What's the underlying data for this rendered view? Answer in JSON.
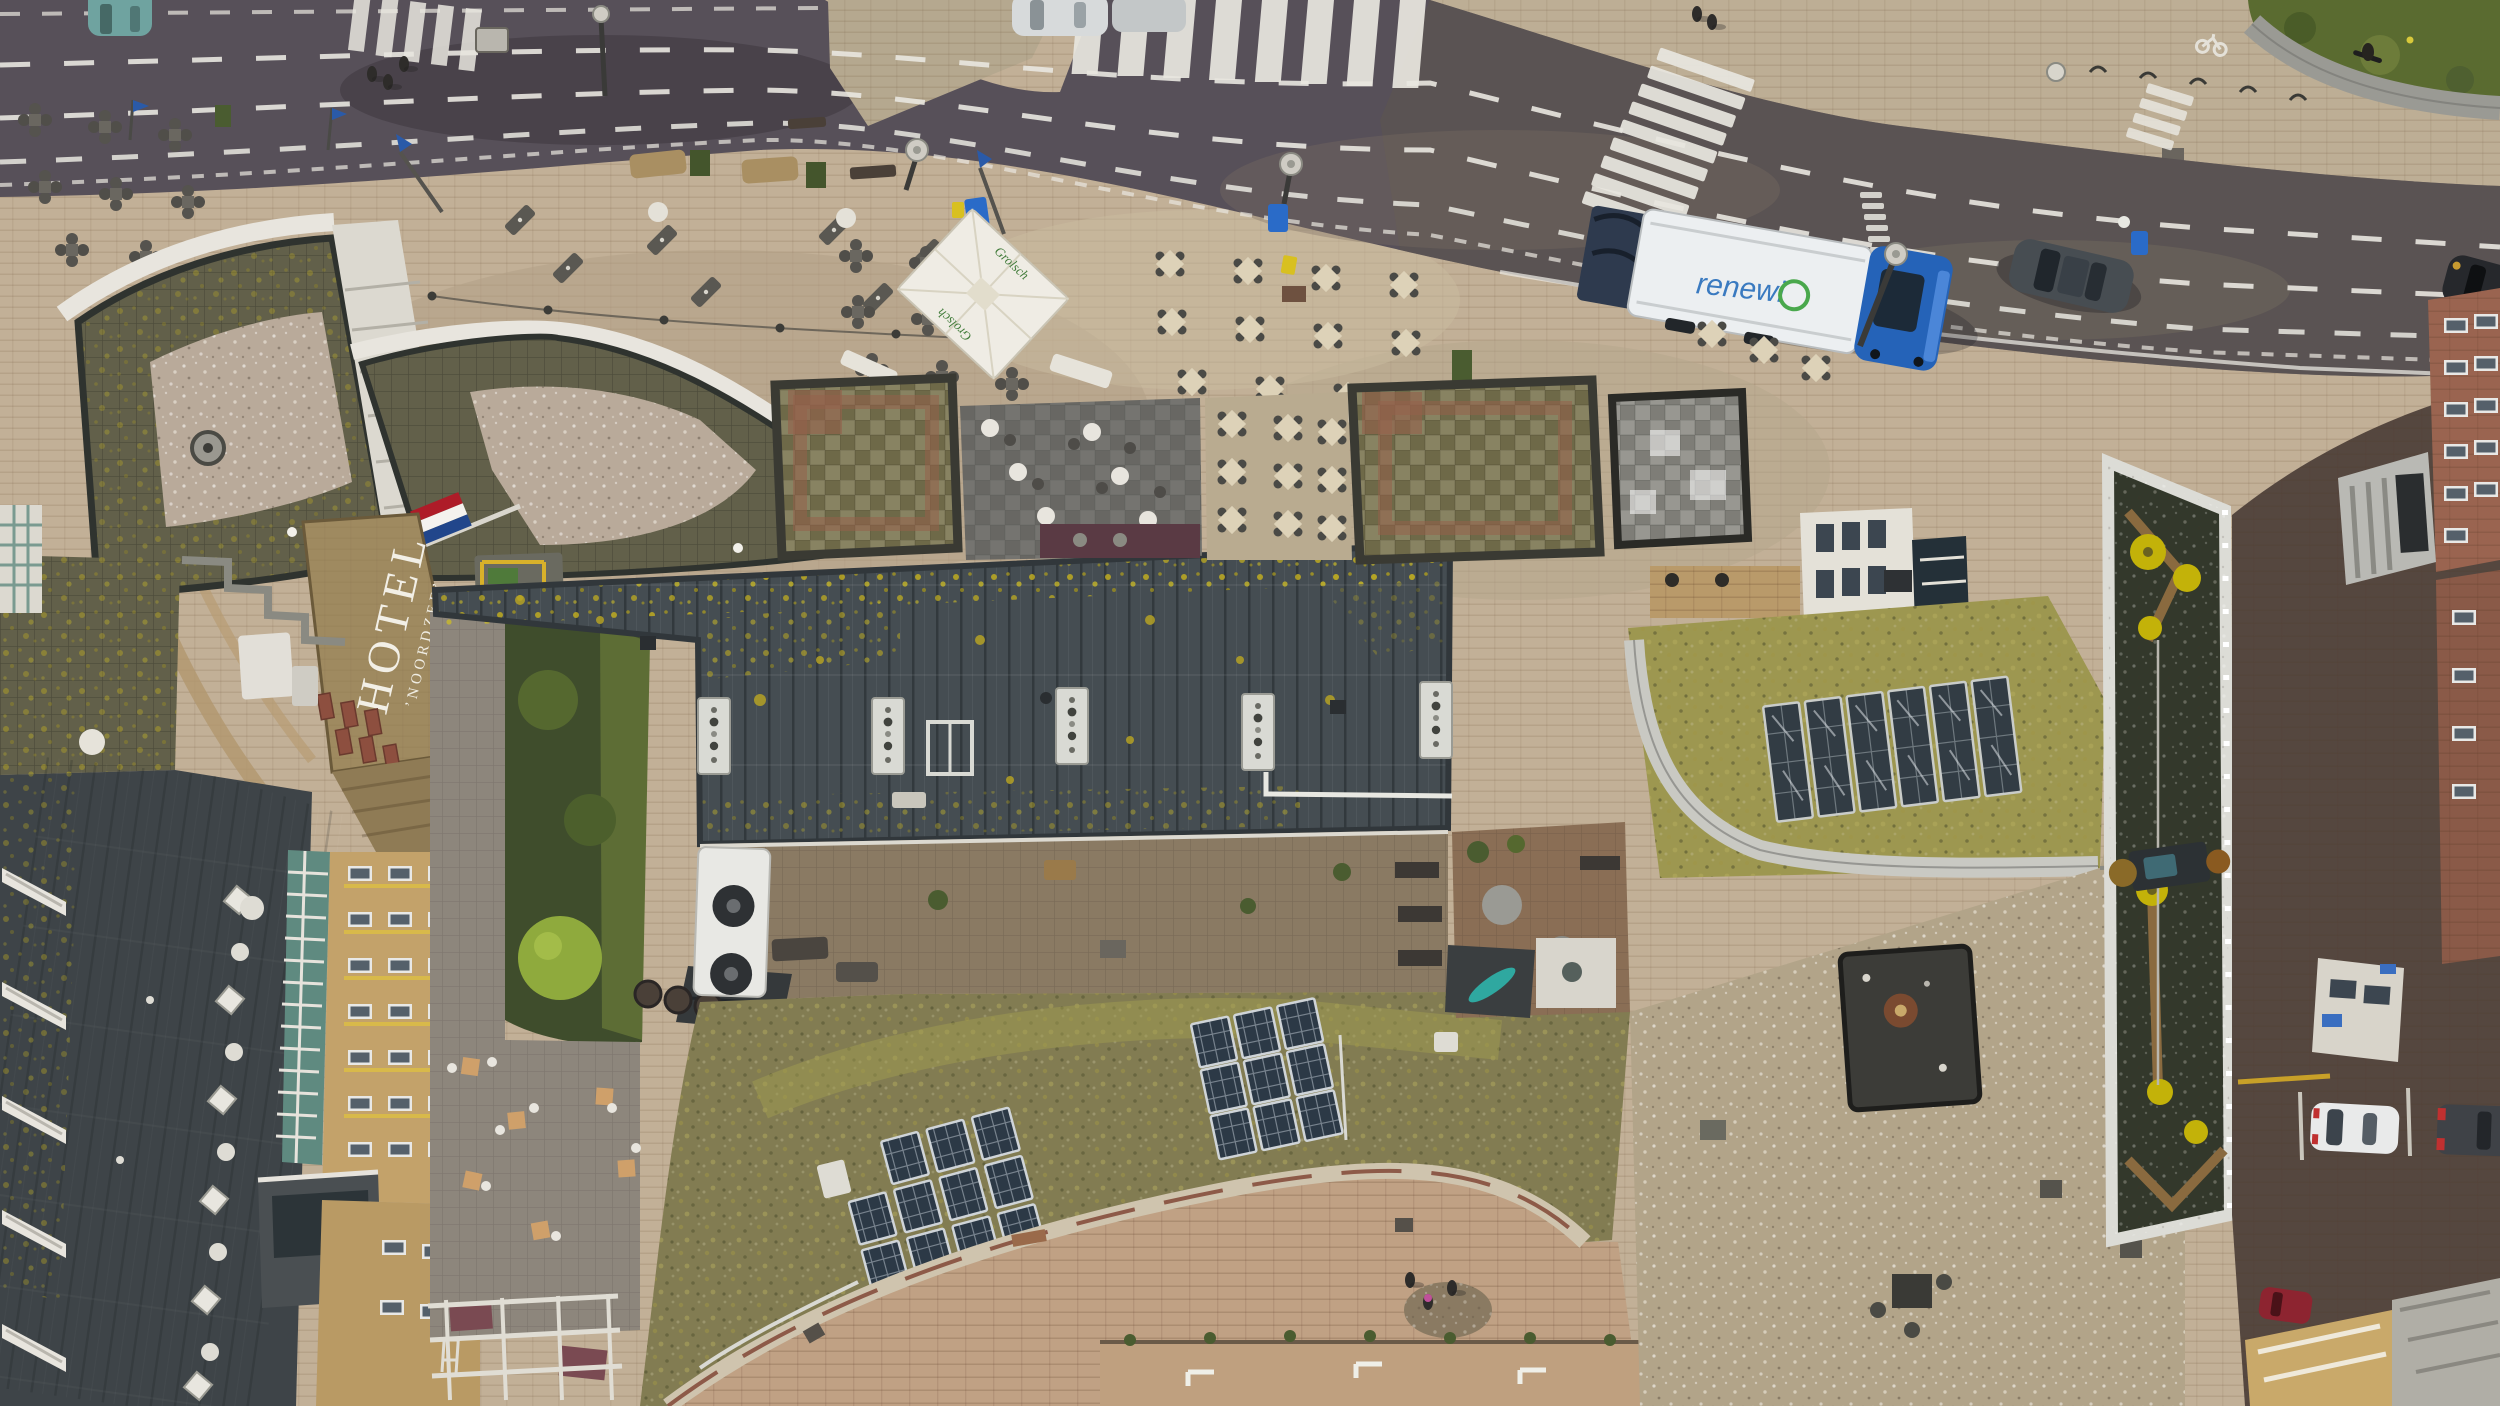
{
  "scene": {
    "type": "aerial-drone-photograph",
    "description": "Straight-down drone view of a Dutch seaside hotel block in autumn: a curving asphalt street with dashed markings, zebra crossings, a blue-and-white garbage truck and cars at top; a beige paved plaza with cafe terraces and parasols; the flat roof of Hotel Noordzee with white roof lettering; large dark bitumen roofs speckled with yellow lichen; sedum green roofs carrying solar-panel arrays; gravel roofs, a dark-green roof with yellow lamp discs; brick side street with parked cars at right.",
    "camera": "nadir (top-down)"
  },
  "labels": {
    "hotel_sign_line1": "HOTEL",
    "hotel_sign_line2": "’NOORDZEE’",
    "umbrella_brand": "Grolsch",
    "truck_logo": "renewi"
  },
  "colors": {
    "road": "#575059",
    "road_right": "#5c554f",
    "marking": "#e9e7e0",
    "plaza": "#c2b097",
    "plaza_worn": "#b2a086",
    "sidewalk_upper": "#bdae95",
    "grass": "#5a6b30",
    "roof_dark": "#454d52",
    "lichen": "#c2ae22",
    "roof_mossy": "#62604a",
    "gravel": "#b9aa9a",
    "roof_tan": "#9f8a60",
    "dormer_red": "#8d4f3f",
    "olive_checker": "#7b7550",
    "red_tile": "#95604b",
    "grey_checker": "#8c8b85",
    "sedum": "#827c52",
    "sedum_bright": "#9d9750",
    "solar_panel": "#2c3946",
    "gravel_right": "#b2a489",
    "roof_green_dark": "#33382b",
    "lamp_yellow": "#c3b209",
    "path_brown": "#8a6a3f",
    "courtyard": "#c0a184",
    "wall_stone": "#cfc4ae",
    "side_street": "#55473f",
    "brick_facade": "#9a6450",
    "facade_tan": "#c3a26a",
    "atrium_glass": "#5f8a80",
    "slate_roof": "#3e4448",
    "white_trim": "#e8e5dc",
    "sign_teal": "#2f8b8f",
    "truck_cab": "#2563b8",
    "truck_body": "#eceff1",
    "car_teal": "#6fa3a0",
    "car_silver": "#d7dadb",
    "car_suv": "#474d52",
    "car_black": "#26282c",
    "car_white": "#e9eaea",
    "van_dark": "#3f4247",
    "car_red": "#8d2430",
    "flag_red": "#ae1c28",
    "flag_blue": "#21468b",
    "tree_green": "#8faa3d",
    "tree_autumn": "#b5762e",
    "playground_yellow": "#d8b12a",
    "umbrella_white": "#efece4"
  },
  "inventory": {
    "vehicles": [
      {
        "name": "garbage-truck",
        "cab": "blue",
        "body": "white",
        "logo": "renewi",
        "location": "main road near zebra crossing"
      },
      {
        "name": "teal-hatchback",
        "location": "top-left road edge"
      },
      {
        "name": "silver-car",
        "location": "top edge of road"
      },
      {
        "name": "grey-suv",
        "location": "right stretch of road, driving"
      },
      {
        "name": "black-car",
        "location": "far right road edge"
      },
      {
        "name": "white-parked-car",
        "location": "side-street parking bay"
      },
      {
        "name": "dark-van",
        "location": "side-street parking bay"
      },
      {
        "name": "red-parked-car",
        "location": "bottom-right side street"
      }
    ],
    "people": {
      "plaza_pedestrians": 3,
      "upper_pavement_pedestrians": 2,
      "cyclist_on_road": 1,
      "courtyard_people": 3
    },
    "solar": {
      "array_left_green_roof": {
        "rows": 3,
        "cols": 3,
        "tilt": "angled on sedum roof"
      },
      "array_right_green_roof": {
        "rows": 3,
        "cols": 3
      },
      "row_on_curved_green_roof": {
        "panels": 6
      }
    },
    "crossings": {
      "zebra_top": 8,
      "zebra_mid_road": 9,
      "zebra_far_right_partial": 4,
      "giveway_ticks": 11
    },
    "terraces": [
      {
        "name": "left-terrace",
        "furniture": "dark wicker chair clusters",
        "clusters": 8
      },
      {
        "name": "middle-terrace",
        "furniture": "closed grey parasols, planters, round tables"
      },
      {
        "name": "grolsch-terrace",
        "furniture": "wicker sets under white Grolsch umbrella",
        "clusters": 9
      },
      {
        "name": "cream-table-terrace",
        "tables": 11
      },
      {
        "name": "roof-terrace-slate",
        "round_tables": 6
      },
      {
        "name": "roof-terrace-cream",
        "tables": 9
      }
    ],
    "roofs": [
      "hotel wing mossy-tile roofs with gravel centres",
      "hotel noordzee tan roof with white lettering and red dormers",
      "large dark bitumen roof with yellow lichen and 5 white roof hatches",
      "curved sedum roof with two 3x3 solar arrays",
      "olive checker-tile roofs with red tile borders (2)",
      "grey checker roof",
      "right-complex tan gravel roof with dark penthouse block",
      "tilted dark-green roof with 6 yellow lamp discs and brown paths",
      "bottom-left slate roof with skylights and glass atrium"
    ],
    "flags": [
      {
        "type": "dutch-flag",
        "count": 1
      },
      {
        "type": "blue-pennant",
        "count": 2
      }
    ],
    "street_lamps": 5,
    "bins": {
      "blue_wheelie": 3,
      "yellow": 2
    },
    "trees": {
      "garden_green": 3,
      "bright_yellow_green": 1,
      "autumn_orange": 1,
      "plaza_bushes": 2
    }
  }
}
